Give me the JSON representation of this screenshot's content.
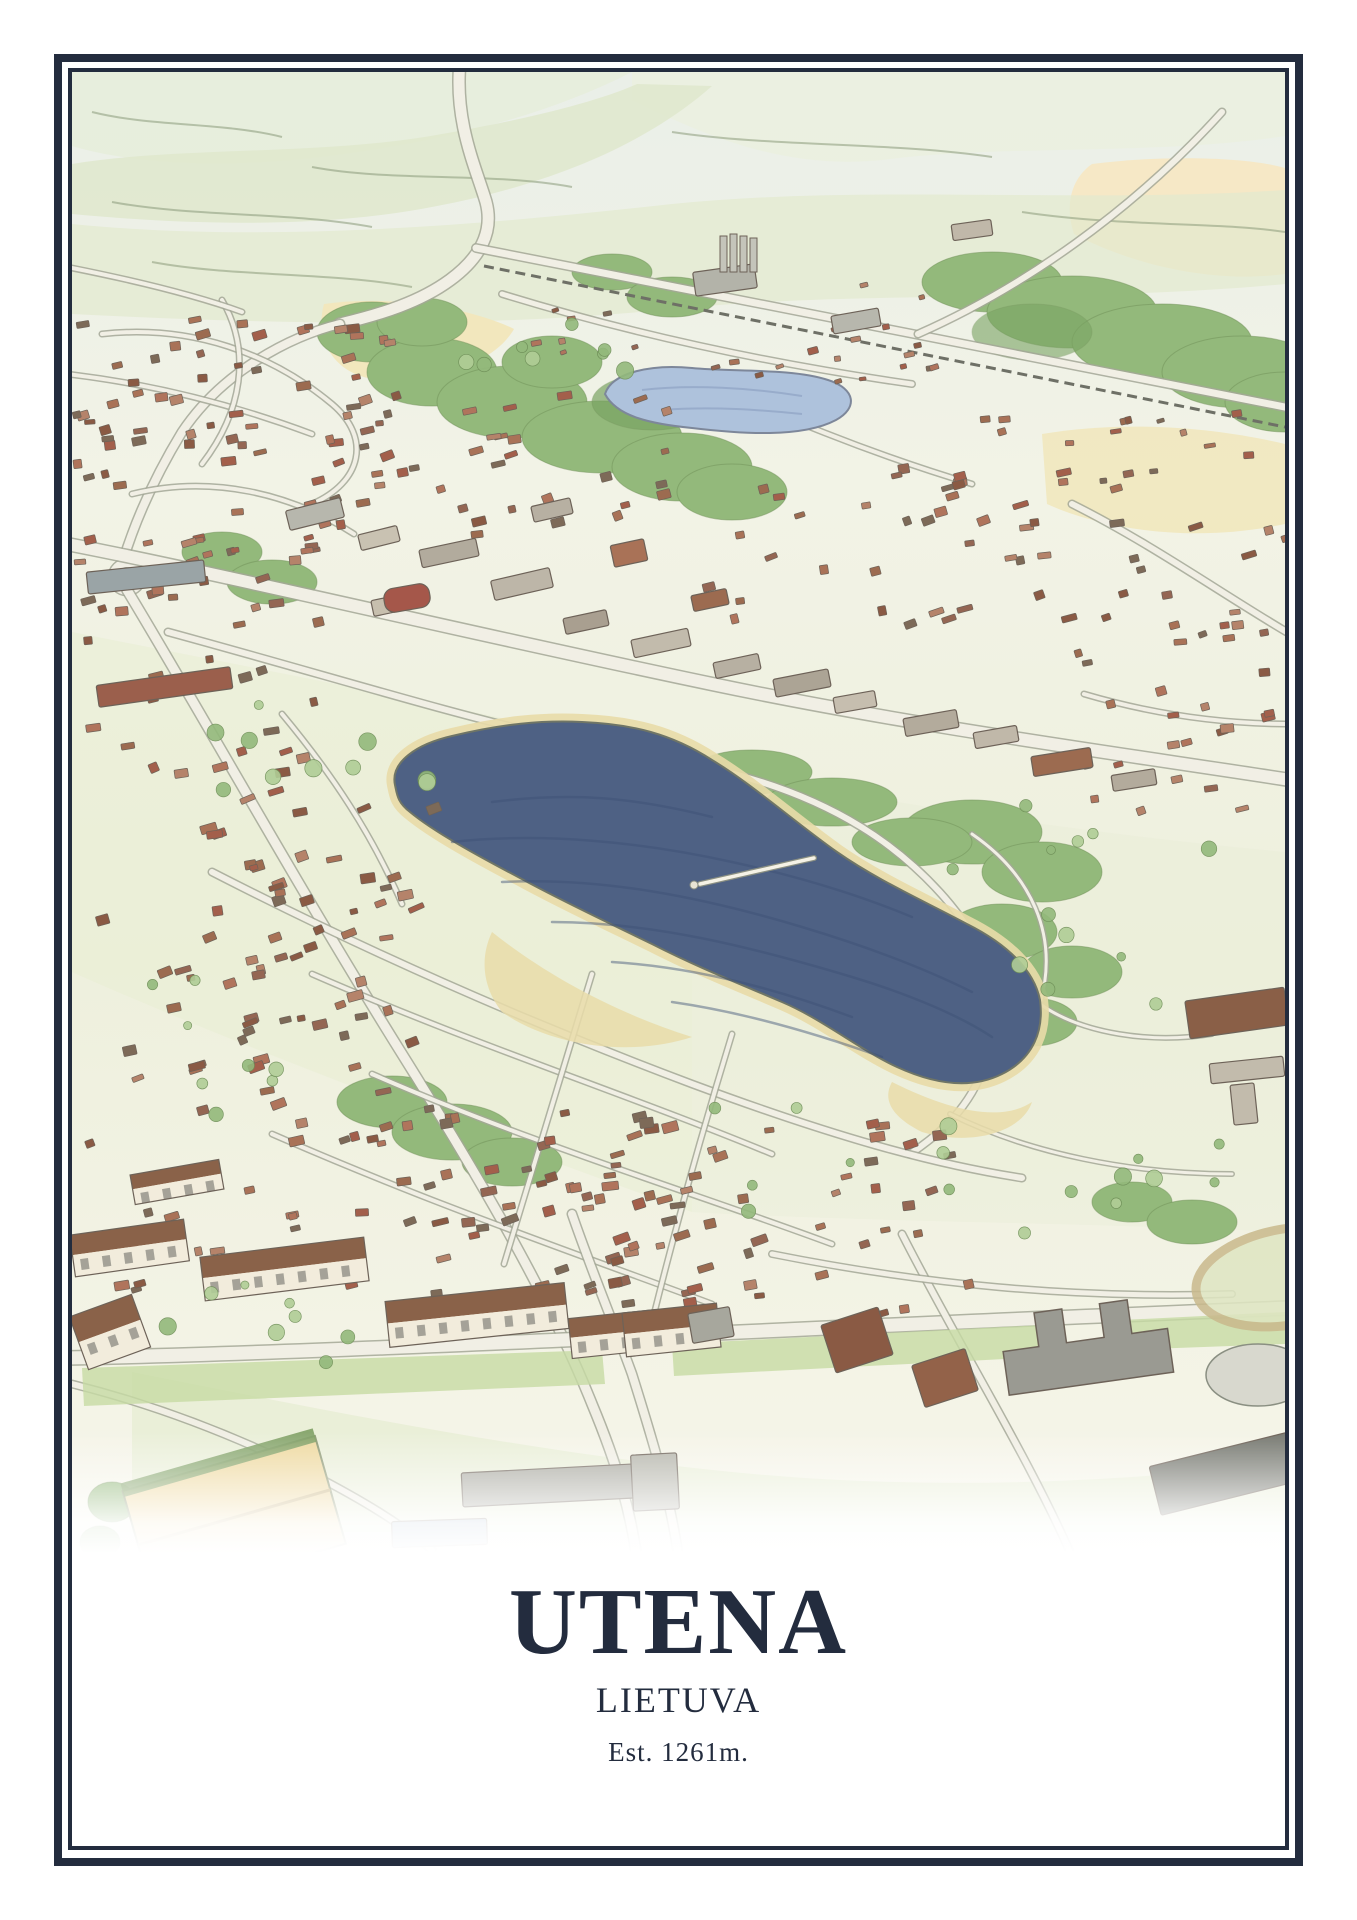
{
  "poster": {
    "title": "UTENA",
    "subtitle": "LIETUVA",
    "caption": "Est. 1261m."
  },
  "palette": {
    "navy": "#232c3e",
    "paper": "#ffffff",
    "field_green": "#e0e9cb",
    "field_green2": "#cfdfb2",
    "median_green": "#c7dba4",
    "field_yellow": "#f2e7bd",
    "field_peach": "#f6e8c6",
    "sports_tan": "#eed9a0",
    "forest": "#93b97b",
    "forest_dark": "#7aa463",
    "forest_light": "#b0cd96",
    "lake": "#4e6184",
    "lake_stroke": "#3d5176",
    "pond": "#aec2dc",
    "sand": "#e9dca9",
    "road_fill": "#f1efe5",
    "road_edge": "#a3a796",
    "line": "#8a8f82",
    "rail": "#6e7066",
    "wall": "#f2ecdc",
    "roof_dark": "#8a6249",
    "window": "#7b7b73"
  },
  "artwork": {
    "roof_colors": [
      "#9c6b50",
      "#a97257",
      "#8a5a44",
      "#b5836a",
      "#a35f4b",
      "#7d6a58",
      "#b0745c",
      "#946653"
    ],
    "roads": [
      {
        "d": "M388,-10 C382,50 404,96 414,130 C422,160 408,186 378,208 C348,230 310,242 268,252",
        "w": 11
      },
      {
        "d": "M268,252 C218,264 150,300 110,360 C82,406 62,452 50,492",
        "w": 8
      },
      {
        "d": "M41,505 a14,14 0 1,0 28,0 a14,14 0 1,0 -28,0",
        "w": 8
      },
      {
        "d": "M404,176 L1218,336",
        "w": 7
      },
      {
        "d": "M412,194 L1218,356",
        "w": 3,
        "type": "rail"
      },
      {
        "d": "M846,262 C950,216 1060,140 1150,40",
        "w": 6
      },
      {
        "d": "M-5,472 C150,502 400,562 640,612 C840,654 1050,682 1218,708",
        "w": 12
      },
      {
        "d": "M96,560 C250,602 380,642 470,662 C560,682 612,692 662,702",
        "w": 6
      },
      {
        "d": "M662,702 C760,728 828,772 878,832 C918,880 933,932 913,992 C898,1036 868,1062 838,1082",
        "w": 6
      },
      {
        "d": "M55,518 C130,642 230,822 330,982 C420,1126 480,1232 520,1332 C545,1392 560,1442 566,1496",
        "w": 9
      },
      {
        "d": "M140,800 C300,882 460,952 620,1012 C760,1064 860,1092 950,1106",
        "w": 6
      },
      {
        "d": "M240,902 C400,972 560,1024 700,1082",
        "w": 4
      },
      {
        "d": "M300,1002 C460,1072 620,1120 760,1172",
        "w": 4
      },
      {
        "d": "M200,1062 C360,1132 500,1180 640,1232",
        "w": 4
      },
      {
        "d": "M520,902 C490,1000 460,1100 432,1192",
        "w": 4
      },
      {
        "d": "M660,962 C630,1060 605,1150 582,1242",
        "w": 4
      },
      {
        "d": "M-5,1286 C300,1280 800,1252 1218,1236",
        "w": 13
      },
      {
        "d": "M500,1142 C520,1200 545,1260 560,1302 C580,1366 600,1430 608,1496",
        "w": 8
      },
      {
        "d": "M830,1162 C890,1280 960,1390 1005,1496",
        "w": 6
      },
      {
        "d": "M0,1312 C80,1332 160,1362 240,1402 C290,1428 330,1452 360,1478",
        "w": 6
      },
      {
        "d": "M700,1182 C850,1212 1000,1227 1160,1222",
        "w": 5
      },
      {
        "d": "M900,762 C958,802 988,862 968,932",
        "w": 3
      },
      {
        "d": "M968,932 C1010,962 1080,972 1140,962",
        "w": 3
      },
      {
        "d": "M878,1042 C958,1082 1060,1102 1160,1102",
        "w": 3
      },
      {
        "d": "M430,222 C560,262 700,292 840,312",
        "w": 5
      },
      {
        "d": "M620,302 C700,342 800,382 900,412",
        "w": 4
      },
      {
        "d": "M1000,432 C1080,472 1150,522 1218,562",
        "w": 6
      },
      {
        "d": "M1012,622 C1080,642 1150,652 1218,652",
        "w": 4
      },
      {
        "d": "M210,642 C260,702 300,762 330,832",
        "w": 4
      },
      {
        "d": "M-5,302 C80,312 160,332 240,362",
        "w": 4
      },
      {
        "d": "M30,262 C120,252 200,282 260,332 C300,366 290,410 240,432",
        "w": 4
      },
      {
        "d": "M60,422 C140,402 220,422 282,462",
        "w": 4
      },
      {
        "d": "M150,228 C180,280 170,340 130,392",
        "w": 4
      },
      {
        "d": "M0,196 C60,208 120,222 170,240",
        "w": 4
      }
    ],
    "blocks": [
      {
        "x": 215,
        "y": 432,
        "w": 56,
        "h": 20,
        "r": -14,
        "f": "#b7b7ad"
      },
      {
        "x": 287,
        "y": 458,
        "w": 40,
        "h": 16,
        "r": -14,
        "f": "#c9c2b2"
      },
      {
        "x": 348,
        "y": 472,
        "w": 58,
        "h": 18,
        "r": -12,
        "f": "#b2ab9d"
      },
      {
        "x": 300,
        "y": 524,
        "w": 44,
        "h": 16,
        "r": -12,
        "f": "#c7bfae"
      },
      {
        "x": 420,
        "y": 502,
        "w": 60,
        "h": 20,
        "r": -13,
        "f": "#bdb6a8"
      },
      {
        "x": 492,
        "y": 542,
        "w": 44,
        "h": 16,
        "r": -12,
        "f": "#a99f90"
      },
      {
        "x": 560,
        "y": 562,
        "w": 58,
        "h": 18,
        "r": -12,
        "f": "#c2bbac"
      },
      {
        "x": 642,
        "y": 586,
        "w": 46,
        "h": 16,
        "r": -12,
        "f": "#b7b0a2"
      },
      {
        "x": 702,
        "y": 602,
        "w": 56,
        "h": 18,
        "r": -11,
        "f": "#aca495"
      },
      {
        "x": 762,
        "y": 622,
        "w": 42,
        "h": 16,
        "r": -10,
        "f": "#c6beaf"
      },
      {
        "x": 832,
        "y": 642,
        "w": 54,
        "h": 18,
        "r": -10,
        "f": "#b3ab9c"
      },
      {
        "x": 902,
        "y": 657,
        "w": 44,
        "h": 16,
        "r": -10,
        "f": "#c0b8a9"
      },
      {
        "x": 312,
        "y": 514,
        "w": 46,
        "h": 24,
        "r": -10,
        "f": "#a5574a",
        "rx": 10
      },
      {
        "x": 15,
        "y": 494,
        "w": 118,
        "h": 22,
        "r": -6,
        "f": "#9aa4a6"
      },
      {
        "x": 25,
        "y": 604,
        "w": 135,
        "h": 22,
        "r": -8,
        "f": "#9b5f4c"
      },
      {
        "x": 540,
        "y": 470,
        "w": 34,
        "h": 22,
        "r": -12,
        "f": "#a97257"
      },
      {
        "x": 460,
        "y": 430,
        "w": 40,
        "h": 16,
        "r": -13,
        "f": "#b7b0a2"
      },
      {
        "x": 620,
        "y": 520,
        "w": 36,
        "h": 16,
        "r": -12,
        "f": "#9c6b50"
      },
      {
        "x": 960,
        "y": 680,
        "w": 60,
        "h": 20,
        "r": -9,
        "f": "#9c6b50"
      },
      {
        "x": 1040,
        "y": 700,
        "w": 44,
        "h": 16,
        "r": -9,
        "f": "#b3ab9c"
      },
      {
        "x": 622,
        "y": 196,
        "w": 62,
        "h": 24,
        "r": -8,
        "f": "#b3b3a9"
      },
      {
        "x": 760,
        "y": 240,
        "w": 48,
        "h": 18,
        "r": -10,
        "f": "#b7b7ad"
      },
      {
        "x": 880,
        "y": 150,
        "w": 40,
        "h": 16,
        "r": -8,
        "f": "#c0b8a9"
      },
      {
        "x": 0,
        "y": 1155,
        "w": 115,
        "h": 42,
        "r": -8,
        "apt": true
      },
      {
        "x": 130,
        "y": 1175,
        "w": 165,
        "h": 44,
        "r": -7,
        "apt": true
      },
      {
        "x": 315,
        "y": 1220,
        "w": 180,
        "h": 46,
        "r": -6,
        "apt": true
      },
      {
        "x": 498,
        "y": 1242,
        "w": 88,
        "h": 40,
        "r": -6,
        "apt": true
      },
      {
        "x": 5,
        "y": 1232,
        "w": 66,
        "h": 56,
        "r": -20,
        "apt": true
      },
      {
        "x": 552,
        "y": 1236,
        "w": 95,
        "h": 44,
        "r": -6,
        "apt": true
      },
      {
        "x": 60,
        "y": 1095,
        "w": 90,
        "h": 30,
        "r": -10,
        "apt": true
      },
      {
        "x": 755,
        "y": 1243,
        "w": 60,
        "h": 50,
        "r": -18,
        "f": "#8a5a44"
      },
      {
        "x": 845,
        "y": 1284,
        "w": 56,
        "h": 44,
        "r": -18,
        "f": "#936249"
      },
      {
        "x": 618,
        "y": 1238,
        "w": 42,
        "h": 30,
        "r": -10,
        "f": "#a7a79d"
      },
      {
        "x": 1080,
        "y": 1368,
        "w": 215,
        "h": 50,
        "r": -14,
        "f": "#787a72"
      },
      {
        "x": 390,
        "y": 1396,
        "w": 190,
        "h": 34,
        "r": -3,
        "f": "#a9a9a0"
      },
      {
        "x": 560,
        "y": 1382,
        "w": 46,
        "h": 56,
        "r": -3,
        "f": "#b5b5ab"
      },
      {
        "x": 320,
        "y": 1448,
        "w": 95,
        "h": 26,
        "r": -2,
        "f": "#9db4c9"
      },
      {
        "x": 1115,
        "y": 922,
        "w": 100,
        "h": 38,
        "r": -8,
        "f": "#8a5f47"
      },
      {
        "x": 1138,
        "y": 988,
        "w": 74,
        "h": 20,
        "r": -6,
        "f": "#c2bbac"
      },
      {
        "x": 1160,
        "y": 1012,
        "w": 24,
        "h": 40,
        "r": -6,
        "f": "#c2bbac"
      }
    ],
    "clusters": [
      {
        "x": 0,
        "y": 240,
        "w": 330,
        "h": 180,
        "n": 55,
        "a": -10,
        "t": "h",
        "s": 1.0
      },
      {
        "x": 0,
        "y": 430,
        "w": 250,
        "h": 200,
        "n": 38,
        "a": -12,
        "t": "h",
        "s": 1.0
      },
      {
        "x": 190,
        "y": 315,
        "w": 430,
        "h": 145,
        "n": 38,
        "a": -14,
        "t": "h",
        "s": 1.0
      },
      {
        "x": 625,
        "y": 390,
        "w": 380,
        "h": 160,
        "n": 38,
        "a": -14,
        "t": "h",
        "s": 1.05
      },
      {
        "x": 1000,
        "y": 445,
        "w": 213,
        "h": 170,
        "n": 22,
        "a": -12,
        "t": "h",
        "s": 1.0
      },
      {
        "x": 440,
        "y": 208,
        "w": 420,
        "h": 105,
        "n": 26,
        "a": -14,
        "t": "h",
        "s": 0.75
      },
      {
        "x": 0,
        "y": 650,
        "w": 360,
        "h": 430,
        "n": 66,
        "a": -16,
        "t": "h",
        "s": 1.1
      },
      {
        "x": 320,
        "y": 1035,
        "w": 380,
        "h": 195,
        "n": 46,
        "a": -14,
        "t": "h",
        "s": 1.1
      },
      {
        "x": 470,
        "y": 1045,
        "w": 430,
        "h": 195,
        "n": 48,
        "a": -14,
        "t": "h",
        "s": 1.1
      },
      {
        "x": 1010,
        "y": 625,
        "w": 200,
        "h": 130,
        "n": 16,
        "a": -12,
        "t": "h",
        "s": 1.0
      },
      {
        "x": 0,
        "y": 1100,
        "w": 290,
        "h": 120,
        "n": 20,
        "a": -10,
        "t": "h",
        "s": 1.0
      },
      {
        "x": 150,
        "y": 782,
        "w": 170,
        "h": 175,
        "n": 22,
        "a": -16,
        "t": "h",
        "s": 1.05
      },
      {
        "x": 905,
        "y": 330,
        "w": 290,
        "h": 90,
        "n": 16,
        "a": -10,
        "t": "h",
        "s": 0.8
      },
      {
        "x": 140,
        "y": 620,
        "w": 220,
        "h": 120,
        "n": 10,
        "t": "t"
      },
      {
        "x": 880,
        "y": 700,
        "w": 320,
        "h": 260,
        "n": 12,
        "t": "t"
      },
      {
        "x": 60,
        "y": 900,
        "w": 200,
        "h": 150,
        "n": 8,
        "t": "t"
      },
      {
        "x": 620,
        "y": 1030,
        "w": 260,
        "h": 110,
        "n": 8,
        "t": "t"
      },
      {
        "x": 340,
        "y": 245,
        "w": 220,
        "h": 120,
        "n": 8,
        "t": "t"
      },
      {
        "x": 60,
        "y": 1180,
        "w": 240,
        "h": 120,
        "n": 8,
        "t": "t"
      },
      {
        "x": 950,
        "y": 1060,
        "w": 220,
        "h": 120,
        "n": 8,
        "t": "t"
      }
    ]
  }
}
